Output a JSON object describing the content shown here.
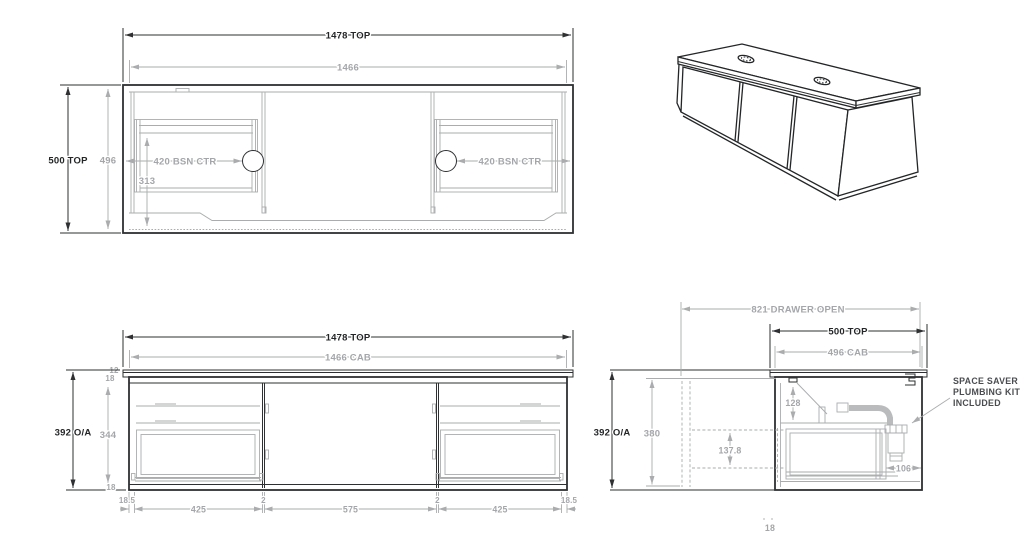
{
  "colors": {
    "line_dark": "#2e3032",
    "line_gray": "#aaacae",
    "text_dark": "#232527",
    "text_gray": "#a4a6a9",
    "note_text": "#4a4c4f",
    "background": "#ffffff"
  },
  "plan_view": {
    "width_top": "1478 TOP",
    "width_cab": "1466",
    "depth_top": "500 TOP",
    "depth_cab": "496",
    "basin_setback": "313",
    "basin_ctr_left": "420 BSN CTR",
    "basin_ctr_right": "420 BSN CTR"
  },
  "front_view": {
    "width_top": "1478 TOP",
    "width_cab": "1466 CAB",
    "top_thickness": "12",
    "top_rail": "18",
    "height_overall": "392 O/A",
    "door_height": "344",
    "bottom_rail": "18",
    "margin_left": "18.5",
    "door_left": "425",
    "gap_left": "2",
    "door_middle": "575",
    "gap_right": "2",
    "door_right": "425",
    "margin_right": "18.5"
  },
  "side_view": {
    "drawer_open": "821 DRAWER OPEN",
    "depth_top": "500 TOP",
    "depth_cab": "496 CAB",
    "height_overall": "392 O/A",
    "internal_height": "380",
    "outlet_drop": "128",
    "drawer_depth": "137.8",
    "trap_clearance": "106",
    "bottom_rail": "18",
    "note_lines": [
      "SPACE SAVER",
      "PLUMBING KIT",
      "INCLUDED"
    ]
  }
}
